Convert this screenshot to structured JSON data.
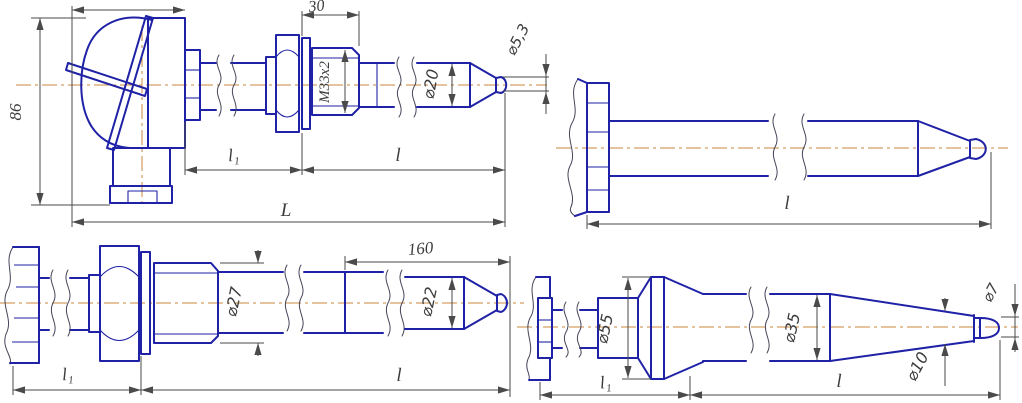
{
  "drawing": {
    "colors": {
      "contour": "#1f22a6",
      "dimension": "#4a4a4a",
      "centerline": "#c8873c",
      "background": "#ffffff"
    },
    "views": {
      "head": {
        "dims": {
          "height": "86",
          "thread_length": "30",
          "thread": "М33х2",
          "body_dia": "⌀20",
          "tip_dia": "⌀5,3",
          "l1": "l₁",
          "l": "l",
          "total_length": "L"
        }
      },
      "flanged": {
        "dims": {
          "l": "l"
        }
      },
      "stepped": {
        "dims": {
          "tip_length": "160",
          "thread_dia": "⌀27",
          "body_dia": "⌀22",
          "l1": "l₁",
          "l": "l"
        }
      },
      "tapered": {
        "dims": {
          "flange_dia": "⌀55",
          "body_dia": "⌀35",
          "cone_dia": "⌀10",
          "tip_dia": "⌀7",
          "l1": "l₁",
          "l": "l"
        }
      }
    }
  }
}
